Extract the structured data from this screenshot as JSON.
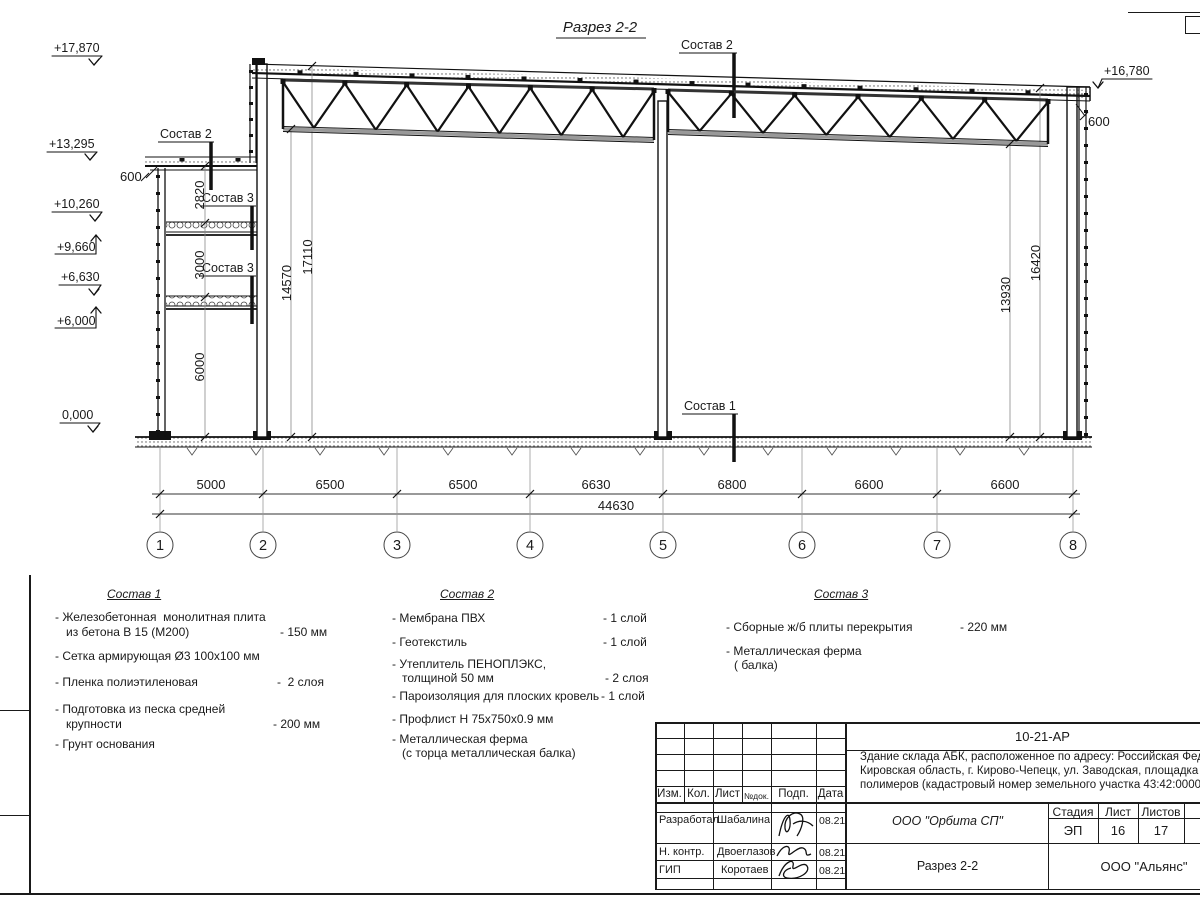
{
  "page_title": "Разрез 2-2",
  "drawing": {
    "composition_labels": {
      "c1": "Состав 1",
      "c2": "Состав 2",
      "c3": "Состав 3"
    },
    "elevations": {
      "top_left": "+17,870",
      "annex_roof": "+13,295",
      "floor2_top": "+10,260",
      "floor2_bottom": "+9,660",
      "floor1_top": "+6,630",
      "floor1_bottom": "+6,000",
      "ground": "0,000",
      "top_right": "+16,780"
    },
    "eaves_left": "600",
    "eaves_right": "600",
    "vertical_dims": {
      "d2820": "2820",
      "d3000": "3000",
      "d6000": "6000",
      "d14570": "14570",
      "d17110": "17110",
      "d13930": "13930",
      "d16420": "16420"
    },
    "span_dims": [
      "5000",
      "6500",
      "6500",
      "6630",
      "6800",
      "6600",
      "6600"
    ],
    "total_dim": "44630",
    "axes": [
      "1",
      "2",
      "3",
      "4",
      "5",
      "6",
      "7",
      "8"
    ]
  },
  "legend": {
    "s1": {
      "heading": "Состав 1",
      "items": [
        {
          "l1": "- Железобетонная  монолитная плита",
          "l2": "из бетона В 15 (М200)",
          "v": "- 150 мм"
        },
        {
          "l1": "- Сетка армирующая Ø3 100х100 мм"
        },
        {
          "l1": "- Пленка полиэтиленовая",
          "v": "-  2 слоя"
        },
        {
          "l1": "- Подготовка из песка средней",
          "l2": "крупности",
          "v": "- 200 мм"
        },
        {
          "l1": "- Грунт основания"
        }
      ]
    },
    "s2": {
      "heading": "Состав 2",
      "items": [
        {
          "l1": "- Мембрана ПВХ",
          "v": "- 1 слой"
        },
        {
          "l1": "- Геотекстиль",
          "v": "- 1 слой"
        },
        {
          "l1": "- Утеплитель ПЕНОПЛЭКС,",
          "l2": "толщиной 50 мм",
          "v": "- 2 слоя"
        },
        {
          "l1": "- Пароизоляция для плоских кровель",
          "v": "- 1 слой"
        },
        {
          "l1": "- Профлист Н 75х750х0.9 мм"
        },
        {
          "l1": "- Металлическая ферма",
          "l2": "(с торца металлическая балка)"
        }
      ]
    },
    "s3": {
      "heading": "Состав 3",
      "items": [
        {
          "l1": "- Сборные ж/б плиты перекрытия",
          "v": "- 220 мм"
        },
        {
          "l1": "- Металлическая ферма",
          "l2": "( балка)"
        }
      ]
    }
  },
  "titleblock": {
    "code": "10-21-АР",
    "description": [
      "Здание склада АБК, расположенное по адресу: Российская Федерация,",
      "Кировская область, г. Кирово-Чепецк, ул. Заводская, площадка завода",
      "полимеров (кадастровый номер земельного участка 43:42:000022:"
    ],
    "rev_headers": [
      "Изм.",
      "Кол.",
      "Лист",
      "№док.",
      "Подп.",
      "Дата"
    ],
    "roles": [
      {
        "role": "Разработал",
        "name": "Шабалина",
        "date": "08.21"
      },
      {
        "role": "Н. контр.",
        "name": "Двоеглазов",
        "date": "08.21"
      },
      {
        "role": "ГИП",
        "name": "Коротаев",
        "date": "08.21"
      }
    ],
    "design_org": "ООО \"Орбита СП\"",
    "sheet_name": "Разрез 2-2",
    "client_org": "ООО \"Альянс\"",
    "stage_headers": [
      "Стадия",
      "Лист",
      "Листов"
    ],
    "stage": "ЭП",
    "sheet_no": "16",
    "sheets_total": "17"
  }
}
